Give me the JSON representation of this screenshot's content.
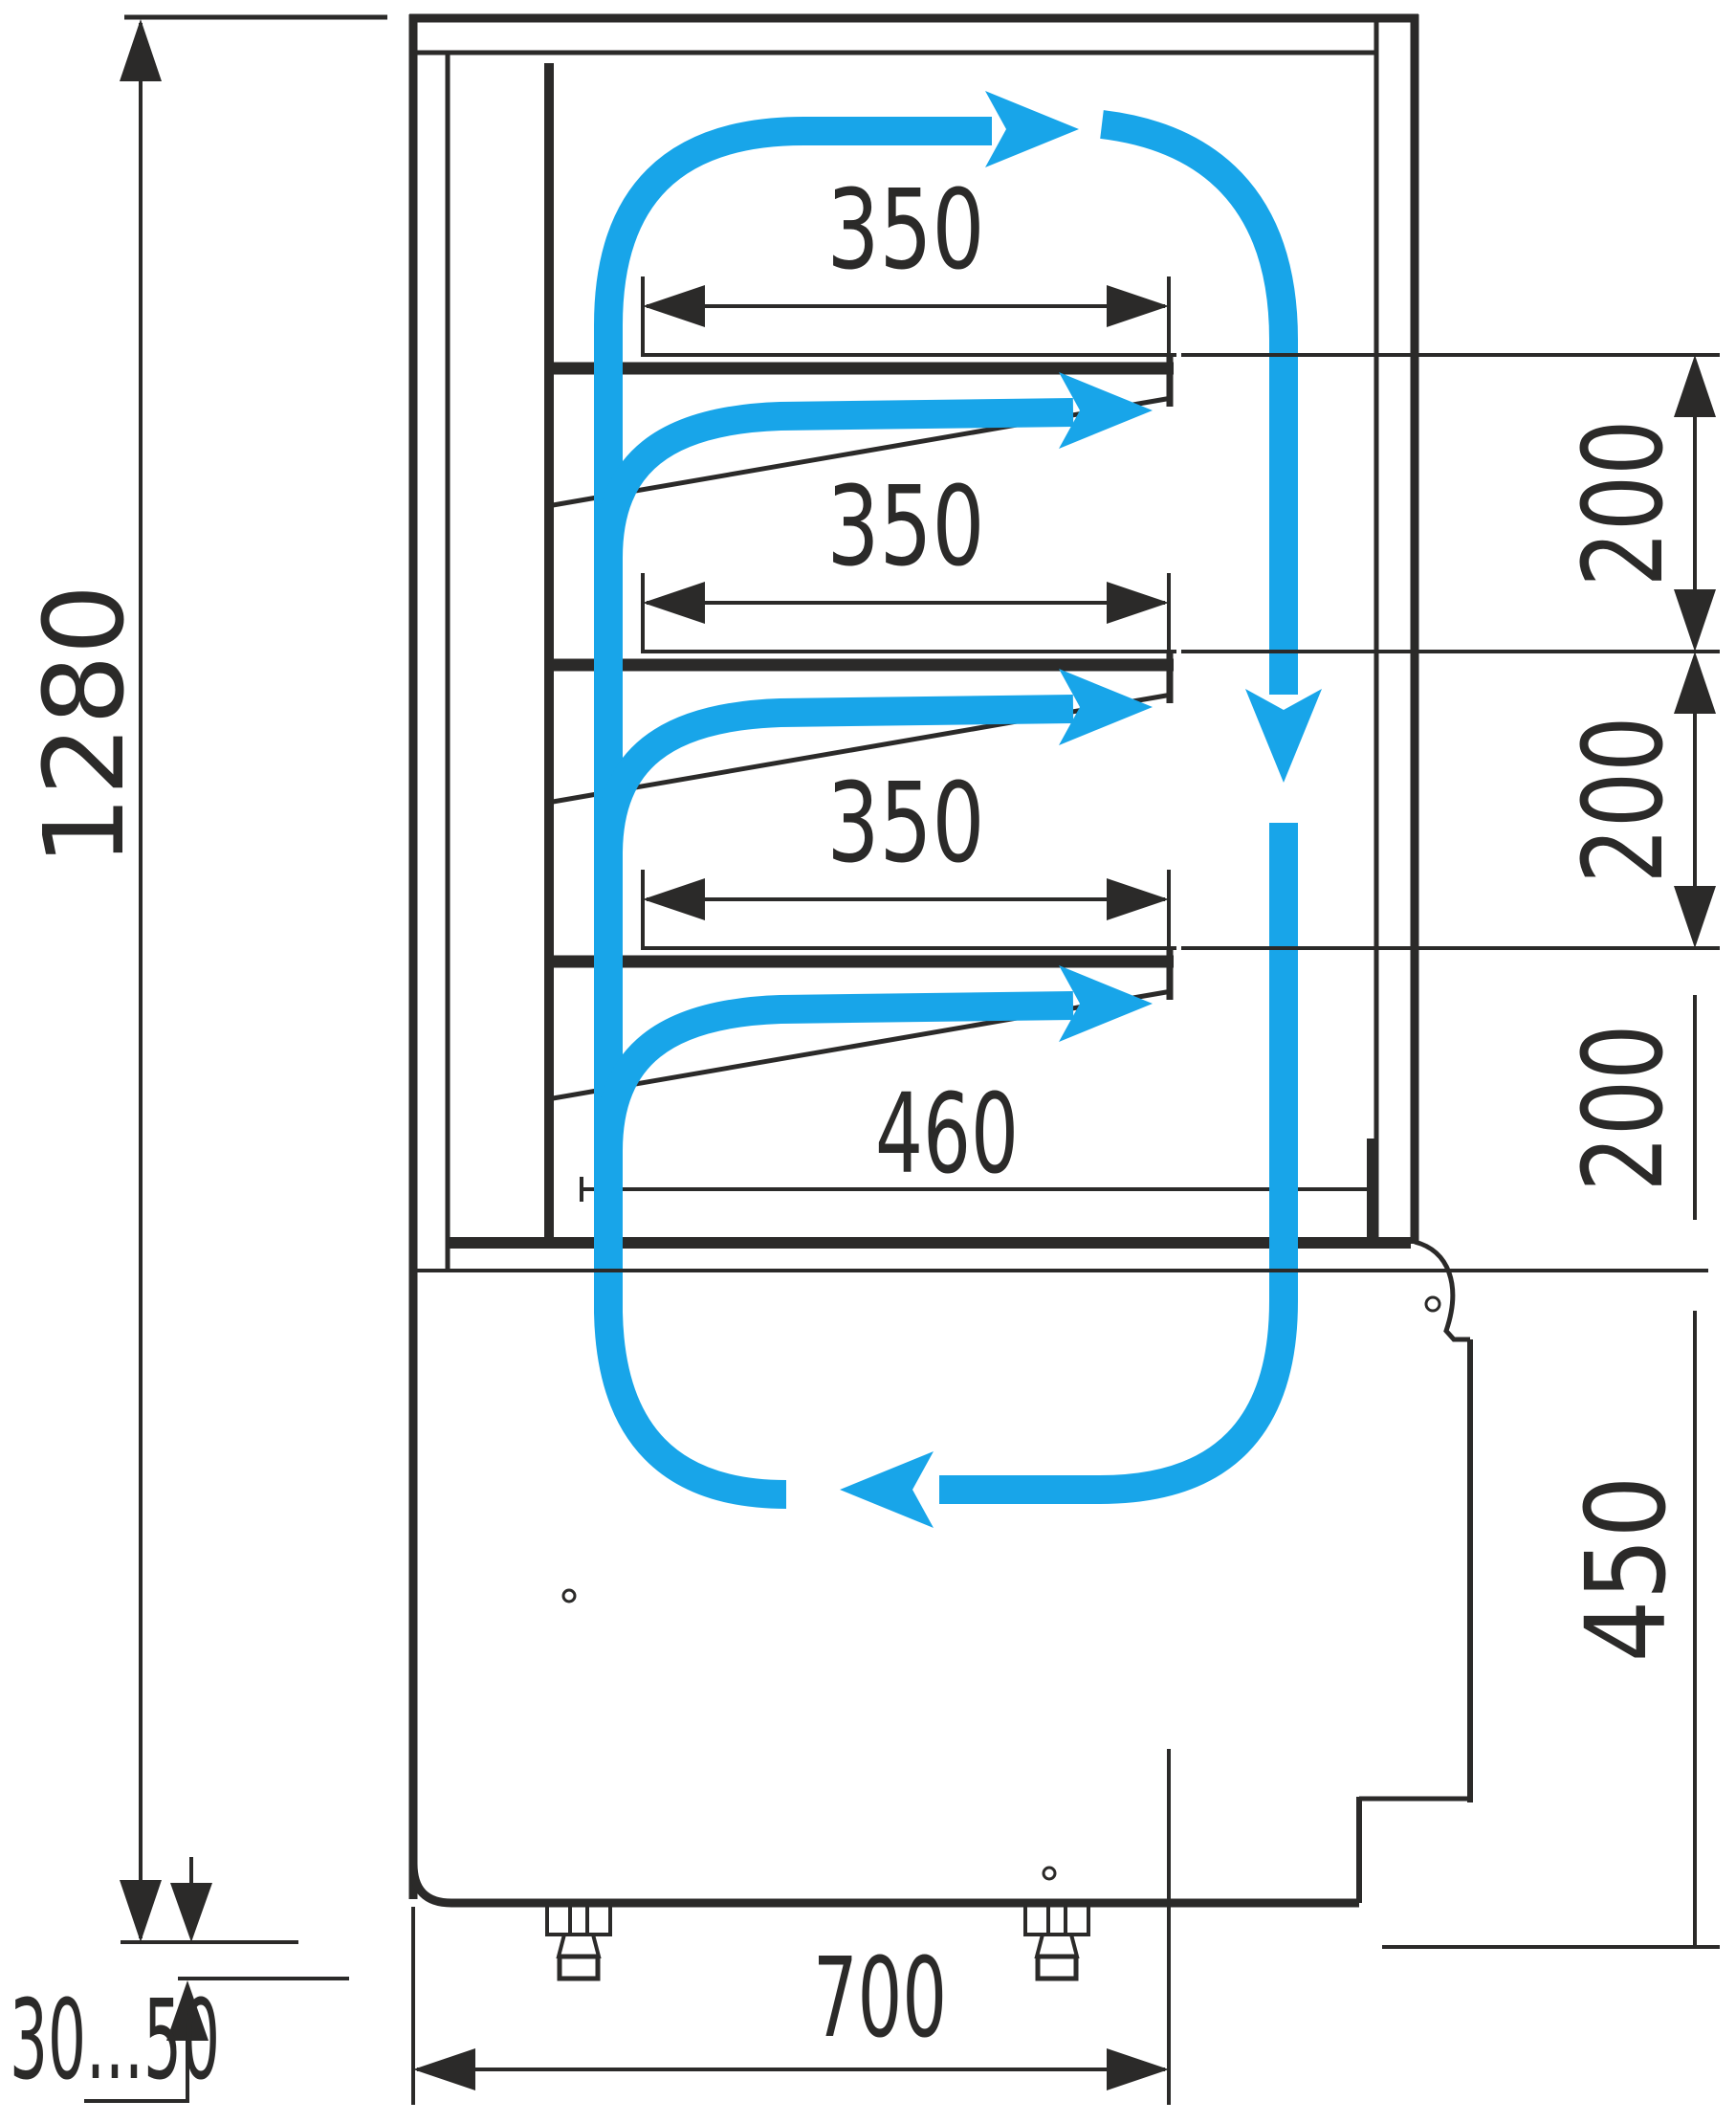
{
  "diagram": {
    "title": "refrigerated-display-case-side-section",
    "type": "technical-drawing",
    "colors": {
      "line": "#2b2a29",
      "flow": "#18a5e9",
      "background": "#ffffff"
    },
    "dims": {
      "overall_height": "1280",
      "shelf_depths": [
        "350",
        "350",
        "350"
      ],
      "shelf_gaps": [
        "200",
        "200",
        "200"
      ],
      "bottom_shelf_depth": "460",
      "base_height": "450",
      "base_depth": "700",
      "foot_range": "30...50"
    }
  }
}
